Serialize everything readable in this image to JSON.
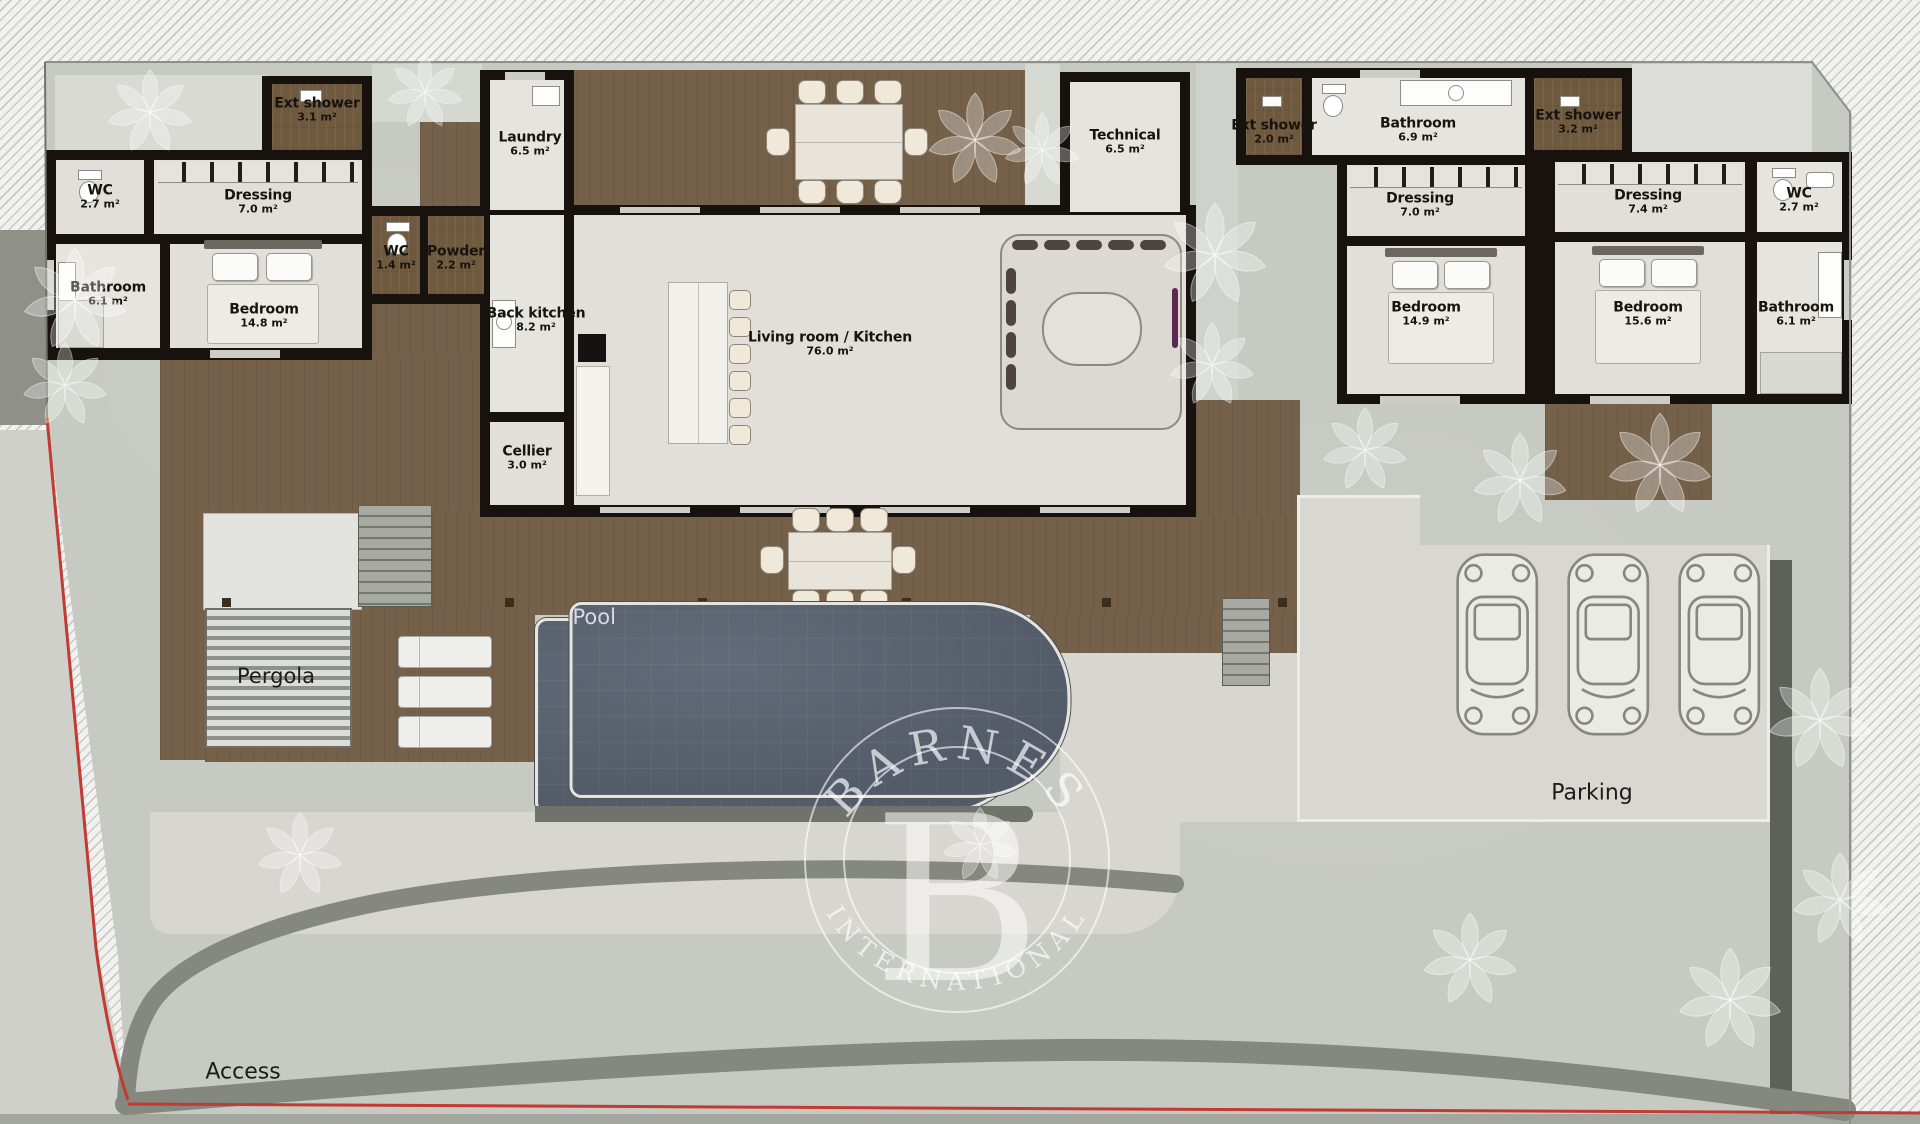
{
  "meta": {
    "document_type": "villa floor plan",
    "brand_watermark": {
      "brand": "BARNES",
      "monogram": "B",
      "subtitle": "INTERNATIONAL"
    }
  },
  "rooms": [
    {
      "name": "Ext shower",
      "area": "3.1 m²"
    },
    {
      "name": "WC",
      "area": "2.7 m²"
    },
    {
      "name": "Dressing",
      "area": "7.0 m²"
    },
    {
      "name": "Bathroom",
      "area": "6.1 m²"
    },
    {
      "name": "Bedroom",
      "area": "14.8 m²"
    },
    {
      "name": "Laundry",
      "area": "6.5 m²"
    },
    {
      "name": "WC",
      "area": "1.4 m²"
    },
    {
      "name": "Powder",
      "area": "2.2 m²"
    },
    {
      "name": "Back kitchen",
      "area": "8.2 m²"
    },
    {
      "name": "Cellier",
      "area": "3.0 m²"
    },
    {
      "name": "Living room / Kitchen",
      "area": "76.0 m²"
    },
    {
      "name": "Technical",
      "area": "6.5 m²"
    },
    {
      "name": "Ext shower",
      "area": "2.0 m²"
    },
    {
      "name": "Bathroom",
      "area": "6.9 m²"
    },
    {
      "name": "Dressing",
      "area": "7.0 m²"
    },
    {
      "name": "Bedroom",
      "area": "14.9 m²"
    },
    {
      "name": "Ext shower",
      "area": "3.2 m²"
    },
    {
      "name": "Dressing",
      "area": "7.4 m²"
    },
    {
      "name": "Bedroom",
      "area": "15.6 m²"
    },
    {
      "name": "WC",
      "area": "2.7 m²"
    },
    {
      "name": "Bathroom",
      "area": "6.1 m²"
    }
  ],
  "outdoor": {
    "pergola": "Pergola",
    "pool": "Pool",
    "parking": "Parking",
    "access": "Access",
    "parking_spots": 3
  },
  "colors": {
    "wall": "#17120d",
    "floor": "#e2dfda",
    "deck_wood": "#75604a",
    "pool_water": "#5a6270",
    "garden": "#c7cac2",
    "boundary_line": "#c23a31",
    "watermark": "#ffffff"
  }
}
